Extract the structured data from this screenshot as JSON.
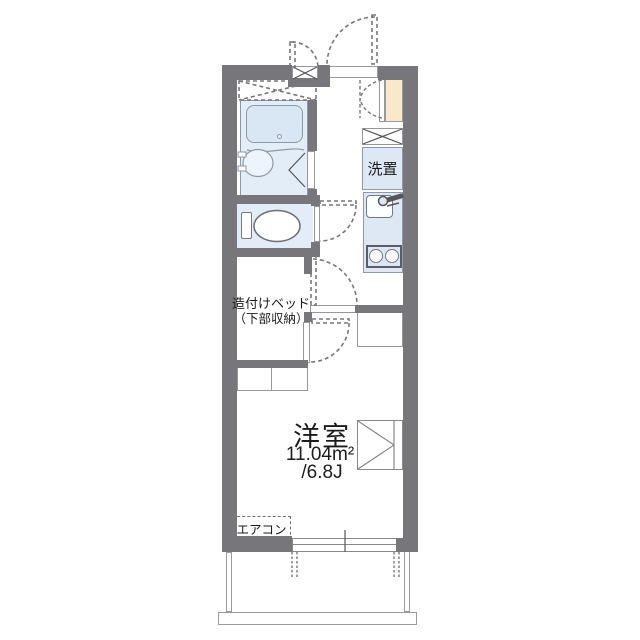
{
  "floorplan": {
    "bed_label_line1": "造付けベッド",
    "bed_label_line2": "（下部収納）",
    "room": {
      "name": "洋室",
      "area_m2": "11.04m²",
      "area_jo": "/6.8J"
    },
    "washer_label": "洗置",
    "aircon_label": "エアコン",
    "symbols": {
      "meter_box": "x-cross-box",
      "washing_machine_space": "x-cross-box",
      "entrance_door": "dashed-swing-arc",
      "closet": "triangle-box"
    },
    "colors": {
      "wall": "#77767b",
      "fixture_blue": "#dde8f4",
      "bath_blue": "#e3edf7",
      "cabinet_beige": "#f7e9c9",
      "line_gray": "#8d99a8",
      "text": "#1c1c1c"
    }
  }
}
